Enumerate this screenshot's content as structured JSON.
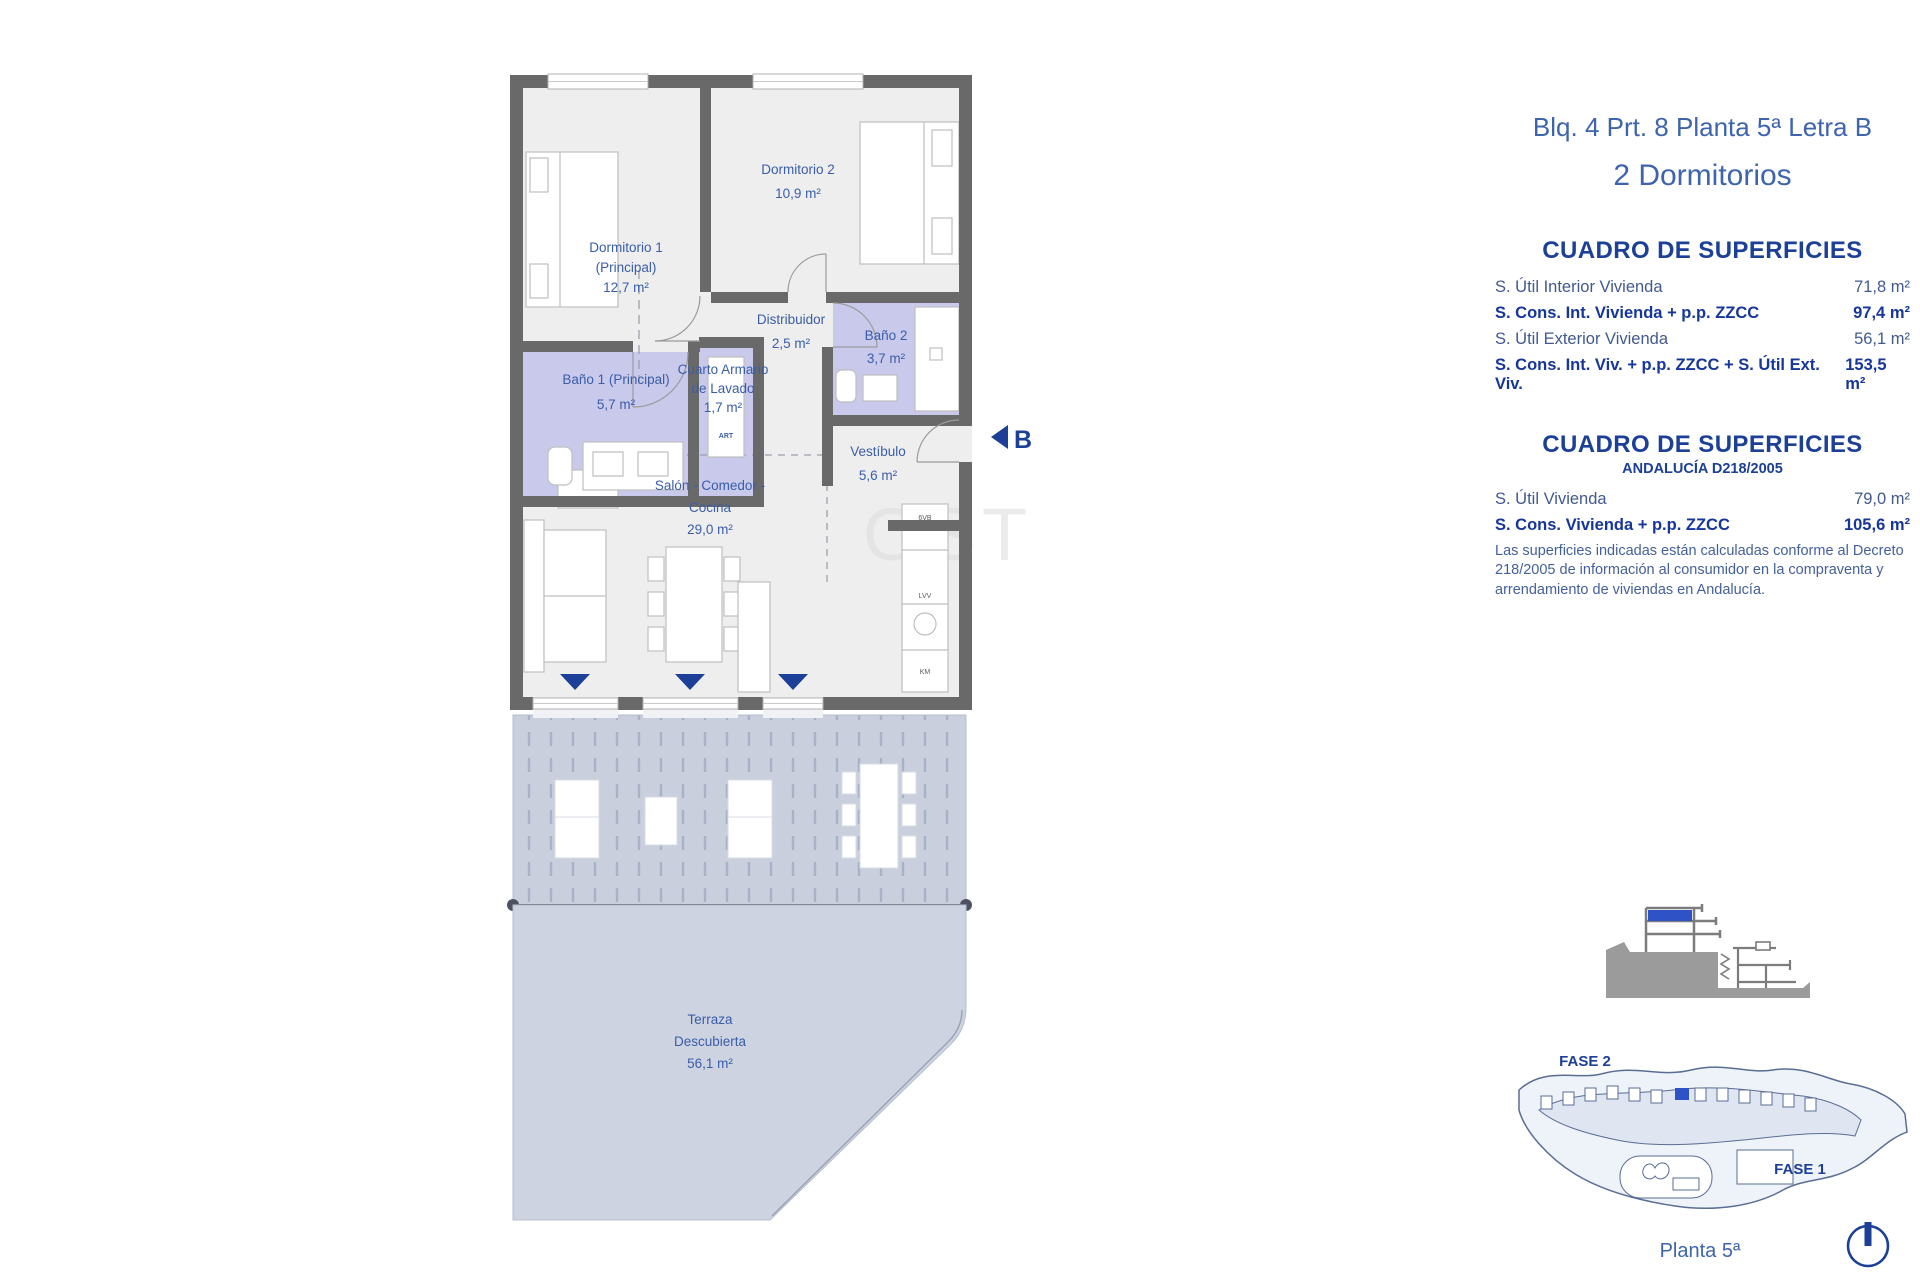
{
  "plan": {
    "marker_b": "B",
    "watermark": "OST",
    "rooms": {
      "dorm2": {
        "name": "Dormitorio 2",
        "area": "10,9 m²"
      },
      "dorm1": {
        "line1": "Dormitorio 1",
        "line2": "(Principal)",
        "area": "12,7 m²"
      },
      "distribuidor": {
        "name": "Distribuidor",
        "area": "2,5 m²"
      },
      "bano2": {
        "name": "Baño 2",
        "area": "3,7 m²"
      },
      "bano1": {
        "name": "Baño 1 (Principal)",
        "area": "5,7 m²"
      },
      "lavado": {
        "line1": "Cuarto Armario",
        "line2": "de Lavado",
        "area": "1,7 m²",
        "tag": "ART"
      },
      "vestibulo": {
        "name": "Vestíbulo",
        "area": "5,6 m²"
      },
      "salon": {
        "line1": "Salón - Comedor -",
        "line2": "Cocina",
        "area": "29,0 m²"
      },
      "terraza": {
        "line1": "Terraza",
        "line2": "Descubierta",
        "area": "56,1 m²"
      }
    },
    "kitchen_labels": {
      "top": "6VB",
      "mid": "LVV",
      "bot": "KM"
    }
  },
  "panel": {
    "title": "Blq. 4 Prt. 8 Planta 5ª Letra B",
    "subtitle": "2 Dormitorios",
    "table1": {
      "title": "CUADRO DE SUPERFICIES",
      "rows": [
        {
          "label": "S. Útil Interior Vivienda",
          "value": "71,8 m²"
        },
        {
          "label": "S. Cons. Int. Vivienda + p.p. ZZCC",
          "value": "97,4 m²"
        },
        {
          "label": "S. Útil Exterior Vivienda",
          "value": "56,1 m²"
        },
        {
          "label": "S. Cons. Int. Viv. + p.p. ZZCC + S. Útil Ext. Viv.",
          "value": "153,5 m²"
        }
      ]
    },
    "table2": {
      "title": "CUADRO DE SUPERFICIES",
      "subtitle": "ANDALUCÍA D218/2005",
      "rows": [
        {
          "label": "S. Útil Vivienda",
          "value": "79,0 m²"
        },
        {
          "label": "S. Cons. Vivienda + p.p. ZZCC",
          "value": "105,6 m²"
        }
      ],
      "note": "Las superficies indicadas están calculadas conforme al Decreto 218/2005 de información al consumidor en la compraventa y arrendamiento de viviendas en Andalucía."
    },
    "siteplan": {
      "fase2": "FASE 2",
      "fase1": "FASE 1"
    },
    "planta_label": "Planta 5ª",
    "colors": {
      "accent": "#1c3f97",
      "highlight": "#2f53c6",
      "wall": "#696969",
      "wet_room": "#c9c9ec",
      "terrace": "#c9cfdd"
    }
  }
}
